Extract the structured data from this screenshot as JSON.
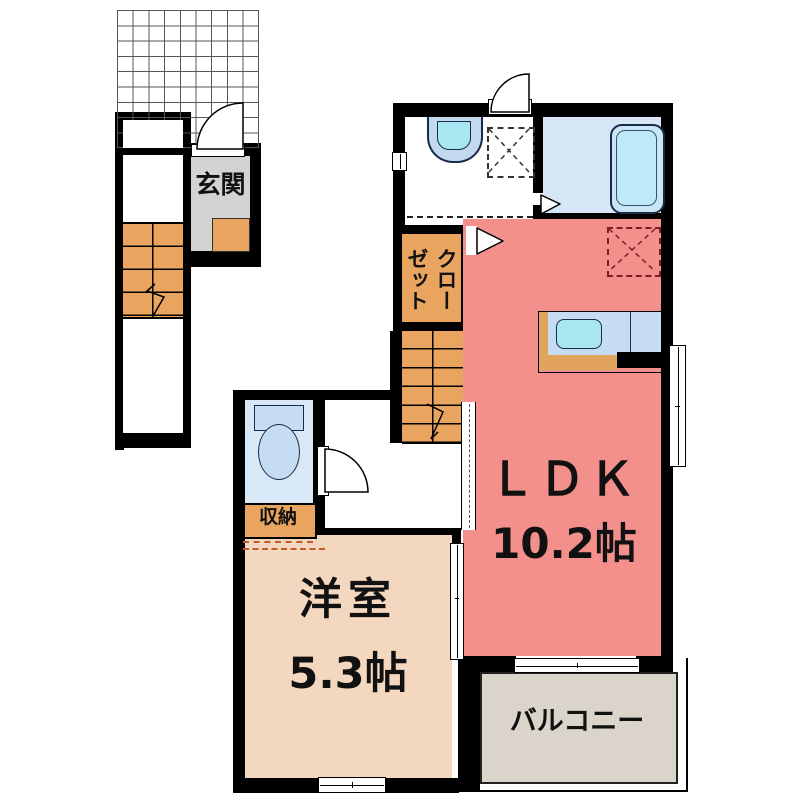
{
  "labels": {
    "entrance": "玄関",
    "closet": "クローゼット",
    "storage": "収納",
    "ldk": "ＬＤＫ",
    "ldk_size": "10.2帖",
    "western_room": "洋室",
    "western_room_size": "5.3帖",
    "balcony": "バルコニー"
  },
  "colors": {
    "wall": "#000000",
    "ldk": "#F4908C",
    "room": "#F3D7BE",
    "balcony": "#DAD4CA",
    "entry": "#D3D3D3",
    "wood": "#E9A45F",
    "bath-blue": "#D6E6F4",
    "toilet-blue": "#D9E8F7",
    "fixture-blue": "#C6DCF2",
    "cyan": "#A8E6F2",
    "dash-red": "#7A2020",
    "dash-orange": "#C25A2A"
  }
}
